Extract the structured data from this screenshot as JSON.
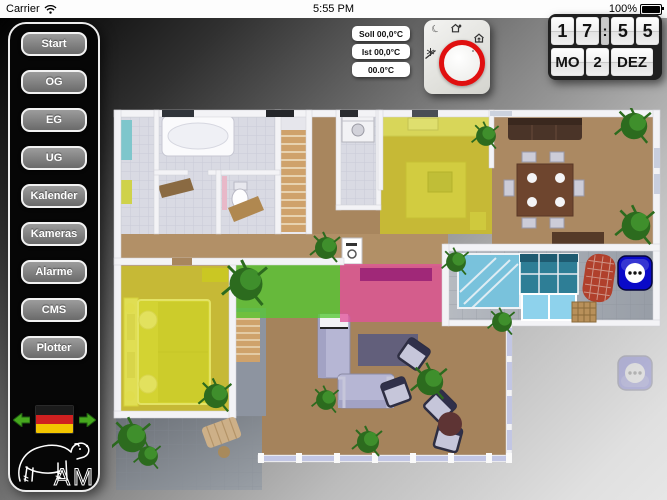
{
  "status_bar": {
    "carrier": "Carrier",
    "time": "5:55 PM",
    "battery": "100%",
    "icons": [
      "wifi-icon",
      "battery-icon"
    ]
  },
  "sidebar": {
    "buttons": [
      "Start",
      "OG",
      "EG",
      "UG",
      "Kalender",
      "Kameras",
      "Alarme",
      "CMS",
      "Plotter"
    ],
    "language_flag": "german-flag",
    "nav_icons": [
      "arrow-left-icon",
      "arrow-right-icon"
    ],
    "logo_text": "AM",
    "logo_icon": "bear-logo"
  },
  "thermostat": {
    "labels": [
      "Soll 00,0°C",
      "Ist 00,0°C",
      "00.0°C"
    ],
    "icons": [
      "night-mode-icon",
      "away-mode-icon",
      "comfort-mode-icon",
      "frost-protection-icon",
      "dial-knob"
    ]
  },
  "clock": {
    "hour_tens": "1",
    "hour_ones": "7",
    "separator": ":",
    "minute_tens": "5",
    "minute_ones": "5",
    "day": "MO",
    "date": "2",
    "month": "DEZ"
  },
  "floor_plan": {
    "zones": [
      {
        "name": "kitchen-zone",
        "color_key": "zone_yellow"
      },
      {
        "name": "bedroom-zone",
        "color_key": "zone_yellow"
      },
      {
        "name": "hall-green-zone",
        "color_key": "zone_green"
      },
      {
        "name": "hall-pink-zone",
        "color_key": "zone_pink"
      }
    ],
    "socket_icon": "power-socket"
  },
  "colors": {
    "dial_ring": "#e01010",
    "zone_yellow": "#d9d91e",
    "zone_green": "#55c832",
    "zone_pink": "#e1529a",
    "socket_blue": "#0a0ac8",
    "arrow_green": "#46a81e"
  }
}
